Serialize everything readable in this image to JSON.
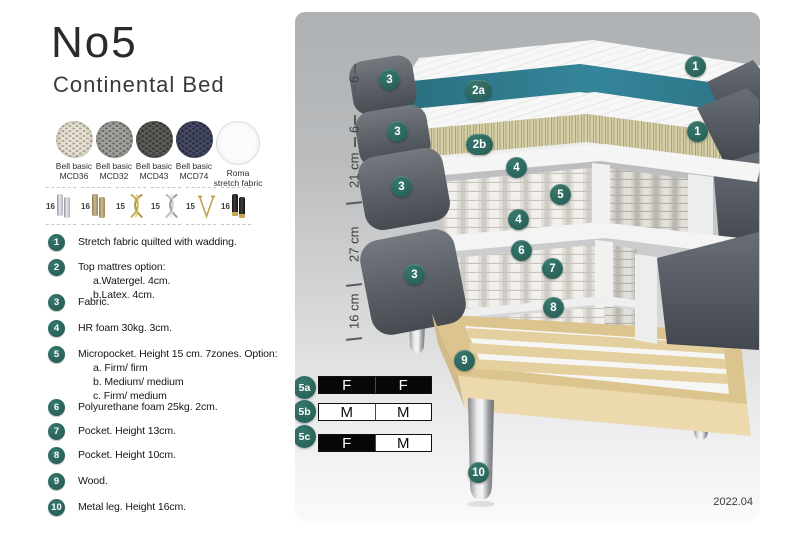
{
  "header": {
    "title": "No5",
    "subtitle": "Continental Bed"
  },
  "fabric_swatches": [
    {
      "name": "Bell basic",
      "code": "MCD36"
    },
    {
      "name": "Bell basic",
      "code": "MCD32"
    },
    {
      "name": "Bell basic",
      "code": "MCD43"
    },
    {
      "name": "Bell basic",
      "code": "MCD74"
    },
    {
      "name": "Roma",
      "code": "stretch fabric"
    }
  ],
  "leg_options": [
    {
      "height": "16",
      "style": "chrome cylinder legs"
    },
    {
      "height": "16",
      "style": "bronze cylinder legs"
    },
    {
      "height": "15",
      "style": "gold twisted legs"
    },
    {
      "height": "15",
      "style": "silver twisted legs"
    },
    {
      "height": "15",
      "style": "gold hairpin leg"
    },
    {
      "height": "16",
      "style": "black legs with brass tip"
    }
  ],
  "features": [
    {
      "num": "1",
      "text": "Stretch fabric quilted with wadding.",
      "subs": []
    },
    {
      "num": "2",
      "text": "Top mattres option:",
      "subs": [
        "a.Watergel. 4cm.",
        "b.Latex. 4cm."
      ]
    },
    {
      "num": "3",
      "text": "Fabric.",
      "subs": []
    },
    {
      "num": "4",
      "text": "HR foam 30kg. 3cm.",
      "subs": []
    },
    {
      "num": "5",
      "text": "Micropocket. Height 15 cm. 7zones. Option:",
      "subs": [
        "a. Firm/ firm",
        "b. Medium/ medium",
        "c. Firm/ medium"
      ]
    },
    {
      "num": "6",
      "text": "Polyurethane foam 25kg. 2cm.",
      "subs": []
    },
    {
      "num": "7",
      "text": "Pocket. Height 13cm.",
      "subs": []
    },
    {
      "num": "8",
      "text": "Pocket. Height 10cm.",
      "subs": []
    },
    {
      "num": "9",
      "text": "Wood.",
      "subs": []
    },
    {
      "num": "10",
      "text": "Metal leg. Height 16cm.",
      "subs": []
    }
  ],
  "diagram": {
    "dimensions": [
      "6",
      "6",
      "21 cm",
      "27 cm",
      "16 cm"
    ],
    "callouts": [
      "1",
      "3",
      "2a",
      "3",
      "2b",
      "1",
      "4",
      "5",
      "3",
      "4",
      "6",
      "7",
      "3",
      "8",
      "9",
      "10"
    ],
    "version": "2022.04"
  },
  "firmness": {
    "rows": [
      {
        "label": "5a",
        "cells": [
          {
            "text": "F",
            "tone": "dark"
          },
          {
            "text": "F",
            "tone": "dark"
          }
        ]
      },
      {
        "label": "5b",
        "cells": [
          {
            "text": "M",
            "tone": "light"
          },
          {
            "text": "M",
            "tone": "light"
          }
        ]
      },
      {
        "label": "5c",
        "cells": [
          {
            "text": "F",
            "tone": "dark"
          },
          {
            "text": "M",
            "tone": "light"
          }
        ]
      }
    ]
  },
  "colors": {
    "badge_teal": "#2b6a64",
    "mattress_teal": "#35859a",
    "latex": "#d6cfa8",
    "wood": "#dcc48f",
    "fabric_gray": "#5d626a"
  }
}
